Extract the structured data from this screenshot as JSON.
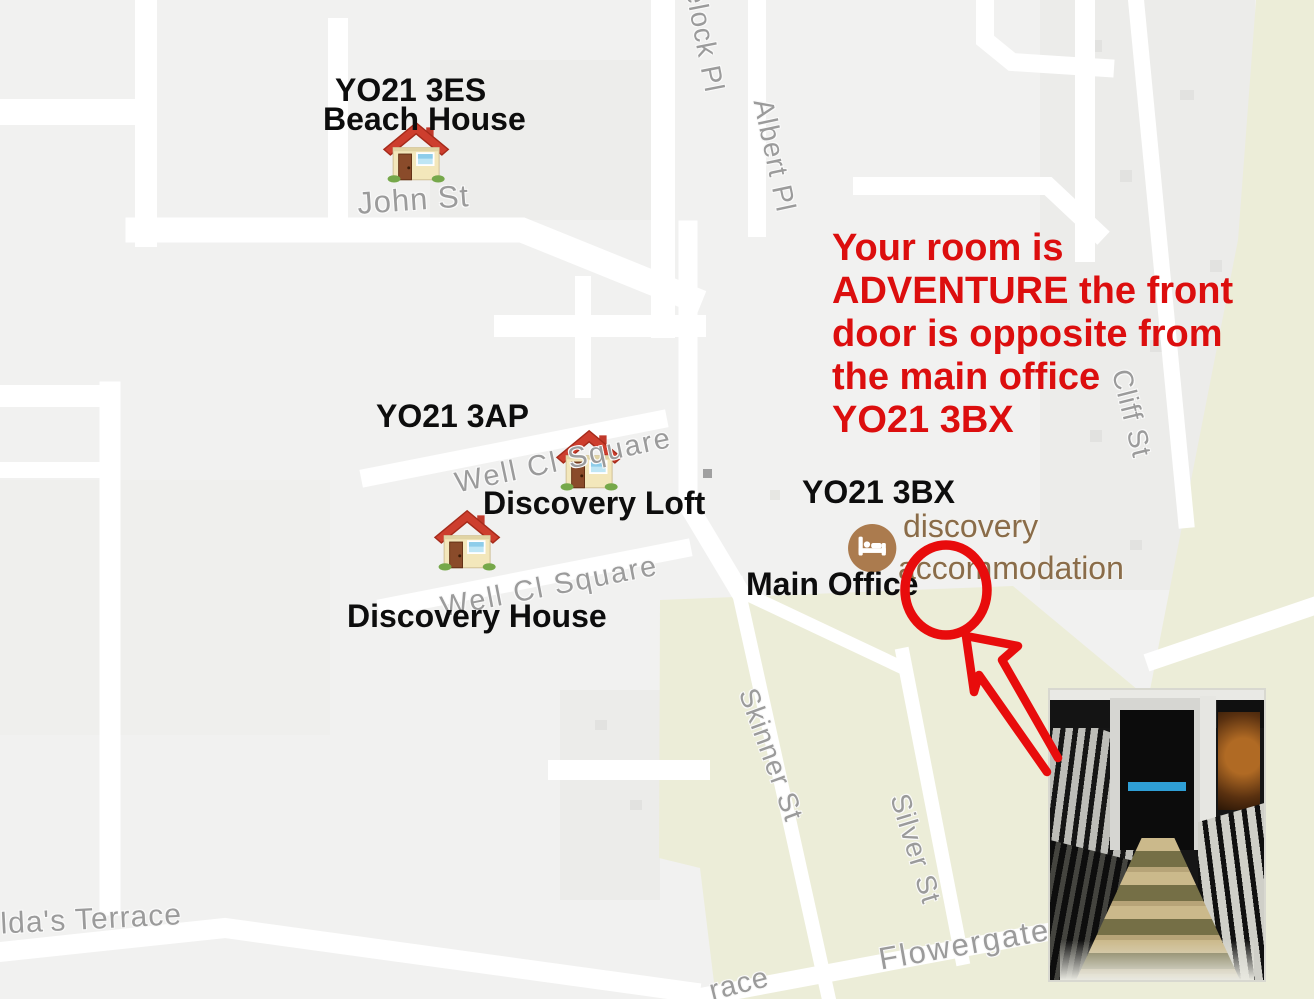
{
  "canvas": {
    "width": 1314,
    "height": 999
  },
  "colors": {
    "map_background": "#f1f1f0",
    "road_white": "#ffffff",
    "area_yellow": "#ecedd8",
    "block_gray": "#ececea",
    "street_label_gray": "#9b9b9b",
    "label_black": "#0d0d0d",
    "annotation_red": "#dc0e0e",
    "poi_text_brown": "#8a6c49",
    "poi_icon_brown": "#ab7b4e",
    "photo_sign_blue": "#2f9fd6"
  },
  "annotation": {
    "lines": [
      "Your room is",
      "ADVENTURE the front",
      "door is opposite from",
      "the main office",
      "YO21 3BX"
    ]
  },
  "markers": {
    "beach_house": {
      "postcode": "YO21 3ES",
      "name": "Beach House"
    },
    "cluster_postcode": "YO21 3AP",
    "discovery_loft": {
      "name": "Discovery Loft"
    },
    "discovery_house": {
      "name": "Discovery House"
    },
    "main_office": {
      "postcode": "YO21 3BX",
      "name": "Main Office"
    }
  },
  "poi": {
    "name_line1": "discovery",
    "name_line2": "accommodation"
  },
  "streets": [
    {
      "name": "avelock Pl"
    },
    {
      "name": "Albert Pl"
    },
    {
      "name": "John St"
    },
    {
      "name": "Well Cl Square"
    },
    {
      "name": "Well Cl Square"
    },
    {
      "name": "Cliff St"
    },
    {
      "name": "Skinner St"
    },
    {
      "name": "Silver St"
    },
    {
      "name": "Flowergate"
    },
    {
      "name": "ilda's Terrace"
    },
    {
      "name": "race"
    }
  ],
  "icons": {
    "house_marker": "house",
    "main_office_poi": "lodging-bed",
    "annotation_shapes": [
      "red-circle",
      "red-arrow"
    ]
  }
}
